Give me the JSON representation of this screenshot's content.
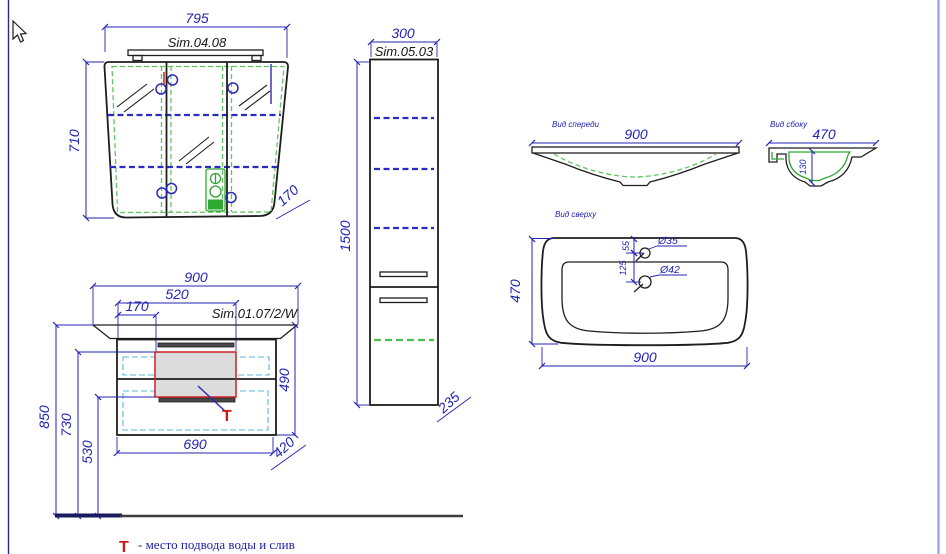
{
  "drawing_title": "Bathroom furniture technical drawing",
  "mirror_cabinet": {
    "model": "Sim.04.08",
    "width": "795",
    "height": "710",
    "depth": "170"
  },
  "tall_cabinet": {
    "model": "Sim.05.03",
    "width": "300",
    "height": "1500",
    "depth": "235"
  },
  "vanity": {
    "model": "Sim.01.07/2/W",
    "width": "900",
    "cutout_width": "520",
    "cutout_offset": "170",
    "height": "490",
    "body_width": "690",
    "depth": "420",
    "top_height": "850",
    "supply_height": "730",
    "drain_height": "530",
    "t_mark": "Т"
  },
  "sink_front": {
    "label": "Вид спереди",
    "width": "900"
  },
  "sink_side": {
    "label": "Вид сбоку",
    "depth": "470",
    "bowl_depth": "130"
  },
  "sink_top": {
    "label": "Вид сверху",
    "depth": "470",
    "width": "900",
    "faucet_hole": "Ø35",
    "drain_hole": "Ø42",
    "faucet_offset": "55",
    "drain_offset": "125"
  },
  "legend": {
    "t_mark": "Т",
    "text": "- место подвода воды и слив"
  },
  "colors": {
    "dimension_blue": "#2323b4",
    "outline_black": "#1e1e1e",
    "shelf_green": "#61c361",
    "drawer_cyan": "#56b8dc",
    "marker_red": "#d02020",
    "zone_fill_gray": "#dcdcdc",
    "frame_left": "#2b2b7e",
    "frame_right": "#9aa0e6",
    "floor_navy": "#1a1a5e"
  }
}
